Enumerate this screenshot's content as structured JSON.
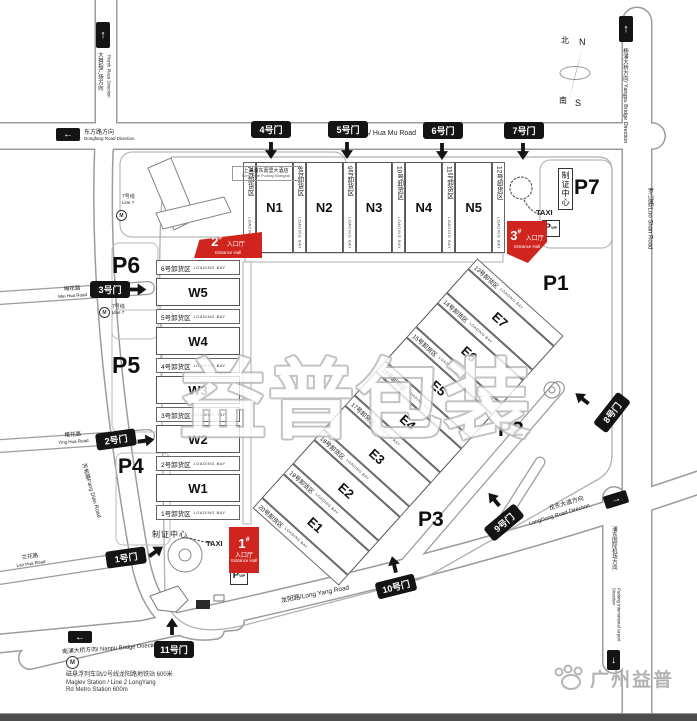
{
  "watermark": "益普包装",
  "logo": "广州益普",
  "compass": {
    "north_cn": "北",
    "north_en": "N",
    "south_cn": "南",
    "south_en": "S"
  },
  "gates": {
    "g1": "1号门",
    "g2": "2号门",
    "g3": "3号门",
    "g4": "4号门",
    "g5": "5号门",
    "g6": "6号门",
    "g7": "7号门",
    "g8": "8号门",
    "g9": "9号门",
    "g10": "10号门",
    "g11": "11号门"
  },
  "halls": {
    "n": [
      "N1",
      "N2",
      "N3",
      "N4",
      "N5"
    ],
    "w": [
      "W5",
      "W4",
      "W3",
      "W2",
      "W1"
    ],
    "e": [
      "E7",
      "E6",
      "E5",
      "E4",
      "E3",
      "E2",
      "E1"
    ]
  },
  "bays": {
    "loading_bay": "LOADING BAY",
    "n": [
      "7号卸货区",
      "8号卸货区",
      "9号卸货区",
      "10号卸货区",
      "11号卸货区",
      "12号卸货区"
    ],
    "w": [
      "6号卸货区",
      "5号卸货区",
      "4号卸货区",
      "3号卸货区",
      "2号卸货区",
      "1号卸货区"
    ],
    "e": [
      "13号卸货区",
      "14号卸货区",
      "15号卸货区",
      "16号卸货区",
      "17号卸货区",
      "18号卸货区",
      "19号卸货区",
      "20号卸货区"
    ]
  },
  "parking": {
    "p1": "P1",
    "p2": "P2",
    "p3": "P3",
    "p4": "P4",
    "p5": "P5",
    "p6": "P6",
    "p7": "P7",
    "p": "P",
    "vip": "VIP"
  },
  "entrances": {
    "e1": {
      "num": "1",
      "sup": "#",
      "cn": "入口厅",
      "en": "Entrance Hall"
    },
    "e2": {
      "num": "2",
      "sup": "#",
      "cn": "入口厅",
      "en": "Entrance Hall"
    },
    "e3": {
      "num": "3",
      "sup": "#",
      "cn": "入口厅",
      "en": "Entrance Hall"
    }
  },
  "labels": {
    "cert_center": "制证中心",
    "taxi": "TAXI"
  },
  "roads": {
    "hua_mu": "花木路/ Hua Mu Road",
    "long_yang": "龙阳路/Long Yang Road",
    "luo_shan": "罗山路/Luo Shan Road",
    "mei_hua_cn": "梅花路",
    "mei_hua_en": "Mei Hua Road",
    "ying_hua_cn": "樱花路",
    "ying_hua_en": "Ying Hua Road",
    "fang_dian": "芳甸路Fang Dian Road",
    "lan_hua_cn": "兰花路",
    "lan_hua_en": "Lan Hua Road"
  },
  "directions": {
    "thumb_cn": "大拇指广场方向",
    "thumb_en": "Thumb Plaza Direction",
    "dongfang_cn": "东方路方向",
    "dongfang_en": "Dongfang Road Direction",
    "yangpu": "杨浦大桥方向/ Yangpu Bridge Direction",
    "nanpu": "南浦大桥方向/ Nanpu Bridge Direction",
    "longdong_cn": "龙东大道方向",
    "longdong_en": "LongDong Road Direction",
    "airport_cn": "浦东国际机场方向",
    "airport_en": "Pudong International Airport Direction"
  },
  "metro": {
    "m": "M",
    "line7_cn": "7号线",
    "line7_en": "Line 7",
    "station_cn": "磁悬浮列车站/2号线龙阳路地铁站  600米",
    "station_en1": "Maglev Station / Line 2 LongYang",
    "station_en2": "Rd Metro Station 600m"
  },
  "hotel": {
    "cn": "上海浦东嘉里大酒店",
    "en": "Kerry Hotel Pudong Shanghai"
  }
}
